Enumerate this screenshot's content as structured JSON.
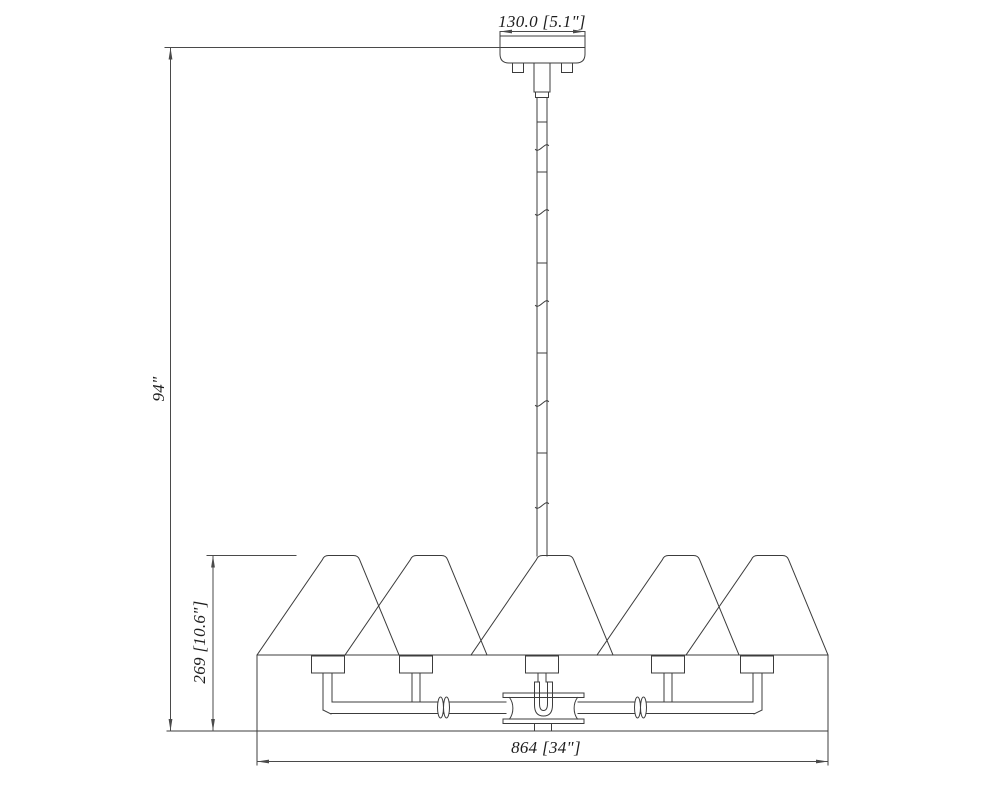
{
  "page": {
    "background_color": "#ffffff",
    "line_color": "#3c3c3c",
    "dimension_line_color": "#4a4a4a",
    "text_color": "#1d1d1d"
  },
  "drawing": {
    "dimensions": {
      "canopy_width": {
        "label": "130.0 [5.1\"]"
      },
      "overall_height": {
        "label": "94\""
      },
      "fixture_height": {
        "label": "269 [10.6\"]"
      },
      "fixture_width": {
        "label": "864 [34\"]"
      }
    }
  }
}
